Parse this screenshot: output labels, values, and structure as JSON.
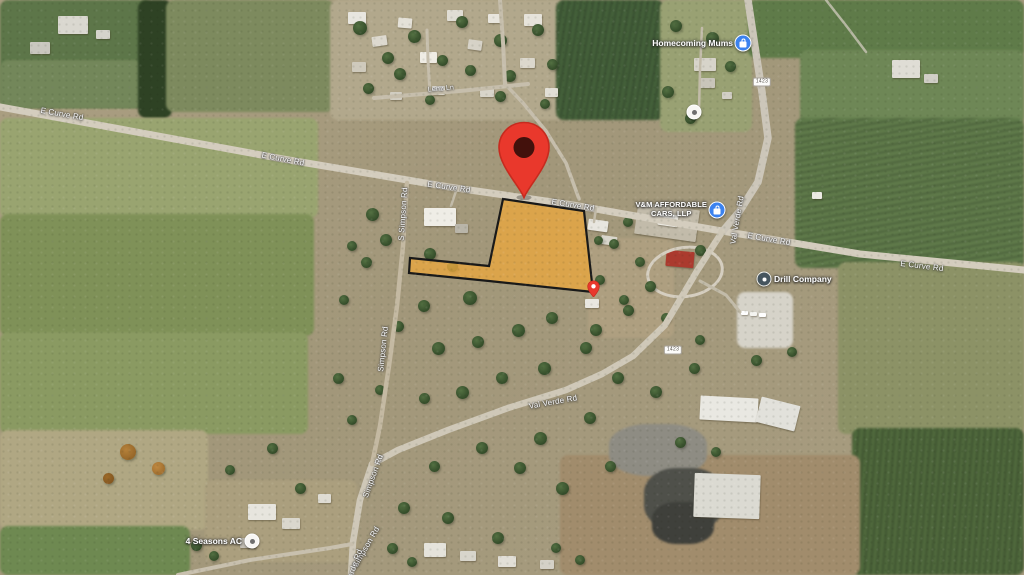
{
  "map": {
    "description": "Satellite map view with a highlighted land parcel and red location pin near E Curve Rd and Val Verde Rd",
    "colors": {
      "parcel_fill": "#EBA83D",
      "parcel_stroke": "#191919",
      "pin_red": "#E9382C",
      "pin_red_dark": "#C62B1F",
      "pin_hole": "#43110C",
      "poi_blue": "#3B82EF",
      "poi_dark": "#46555E",
      "label_white": "#FFFFFF"
    },
    "parcel": {
      "points": [
        [
          503,
          199
        ],
        [
          584,
          211
        ],
        [
          593,
          292
        ],
        [
          489,
          281
        ],
        [
          409,
          273
        ],
        [
          410,
          258
        ],
        [
          489,
          266
        ]
      ]
    },
    "pins": {
      "main": {
        "x": 524,
        "y": 200
      },
      "secondary": {
        "x": 593,
        "y": 297
      }
    },
    "road_labels": [
      {
        "text": "E Curve Rd",
        "x": 62,
        "y": 114,
        "rot": 10
      },
      {
        "text": "E Curve Rd",
        "x": 283,
        "y": 159,
        "rot": 11
      },
      {
        "text": "E Curve Rd",
        "x": 449,
        "y": 187,
        "rot": 8
      },
      {
        "text": "E Curve Rd",
        "x": 573,
        "y": 205,
        "rot": 9
      },
      {
        "text": "E Curve Rd",
        "x": 769,
        "y": 239,
        "rot": 10
      },
      {
        "text": "E Curve Rd",
        "x": 922,
        "y": 266,
        "rot": 7
      },
      {
        "text": "Lenz Ln",
        "x": 441,
        "y": 89,
        "rot": -5,
        "size": 7
      },
      {
        "text": "S Simpson Rd",
        "x": 403,
        "y": 214,
        "rot": -86
      },
      {
        "text": "Simpson Rd",
        "x": 383,
        "y": 349,
        "rot": -84
      },
      {
        "text": "Simpson Rd",
        "x": 373,
        "y": 476,
        "rot": -70
      },
      {
        "text": "Simpson Rd",
        "x": 366,
        "y": 547,
        "rot": -60
      },
      {
        "text": "Verde Rd",
        "x": 354,
        "y": 566,
        "rot": -70
      },
      {
        "text": "Val Verde Rd",
        "x": 737,
        "y": 220,
        "rot": -80
      },
      {
        "text": "Val Verde Rd",
        "x": 553,
        "y": 402,
        "rot": -10
      }
    ],
    "route_shields": [
      {
        "text": "1423",
        "x": 762,
        "y": 82
      },
      {
        "text": "1423",
        "x": 673,
        "y": 350
      }
    ],
    "pois": [
      {
        "id": "homecoming-mums",
        "lines": [
          "Homecoming Mums"
        ],
        "icon": "shopping-blue",
        "x": 743,
        "y": 43,
        "side": "left"
      },
      {
        "id": "vm-affordable-cars",
        "lines": [
          "V&M AFFORDABLE",
          "CARS, LLP"
        ],
        "icon": "shopping-blue",
        "x": 717,
        "y": 210,
        "side": "left",
        "caps": true
      },
      {
        "id": "drill-company",
        "lines": [
          "Drill Company"
        ],
        "icon": "generic-dark",
        "x": 764,
        "y": 279,
        "side": "right"
      },
      {
        "id": "four-seasons-ac",
        "lines": [
          "4 Seasons AC"
        ],
        "icon": "generic-gray",
        "x": 252,
        "y": 541,
        "side": "left"
      },
      {
        "id": "unlabeled-place",
        "lines": [],
        "icon": "generic-gray",
        "x": 694,
        "y": 112,
        "side": "right"
      }
    ]
  }
}
